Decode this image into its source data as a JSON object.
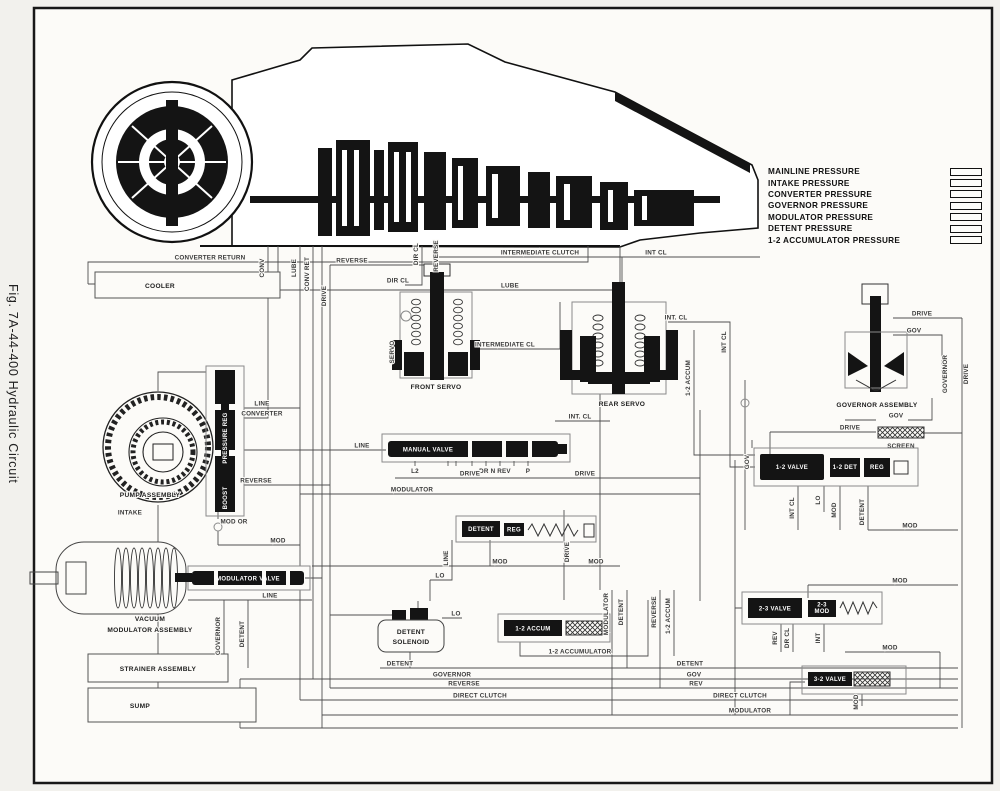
{
  "figure": {
    "caption": "Fig. 7A-44-400 Hydraulic Circuit"
  },
  "legend": {
    "items": [
      {
        "label": "MAINLINE PRESSURE"
      },
      {
        "label": "INTAKE PRESSURE"
      },
      {
        "label": "CONVERTER PRESSURE"
      },
      {
        "label": "GOVERNOR PRESSURE"
      },
      {
        "label": "MODULATOR PRESSURE"
      },
      {
        "label": "DETENT PRESSURE"
      },
      {
        "label": "1-2 ACCUMULATOR PRESSURE"
      }
    ]
  },
  "components": {
    "cooler": "COOLER",
    "pump": "PUMP ASSEMBLY",
    "pressure_reg": "PRESSURE REG",
    "boost": "BOOST",
    "manual_valve": "MANUAL VALVE",
    "front_servo": "FRONT SERVO",
    "rear_servo": "REAR SERVO",
    "governor": "GOVERNOR ASSEMBLY",
    "screen": "SCREEN",
    "modulator_valve": "MODULATOR VALVE",
    "vacuum_modulator_1": "VACUUM",
    "vacuum_modulator_2": "MODULATOR ASSEMBLY",
    "detent_valve": "DETENT",
    "detent_reg": "REG",
    "valve_12": "1-2 VALVE",
    "det_12": "1-2 DET",
    "reg_12": "REG",
    "valve_23": "2-3 VALVE",
    "mod_23_1": "2-3",
    "mod_23_2": "MOD",
    "accum_12": "1-2 ACCUM",
    "valve_32": "3-2 VALVE",
    "detent_solenoid_1": "DETENT",
    "detent_solenoid_2": "SOLENOID",
    "strainer": "STRAINER ASSEMBLY",
    "sump": "SUMP"
  },
  "manual_positions": {
    "l2": "L2",
    "dr_n_rev": "DR N REV",
    "p": "P"
  },
  "line_labels": {
    "converter_return": "CONVERTER RETURN",
    "lube": "LUBE",
    "conv": "CONV",
    "conv_ret": "CONV RET",
    "drive": "DRIVE",
    "reverse": "REVERSE",
    "dir_cl": "DIR CL",
    "intermediate_clutch": "INTERMEDIATE CLUTCH",
    "intermediate_cl": "INTERMEDIATE CL",
    "int_cl": "INT CL",
    "int_cl_dot": "INT. CL",
    "servo": "SERVO",
    "line": "LINE",
    "converter": "CONVERTER",
    "intake": "INTAKE",
    "governor": "GOVERNOR",
    "gov": "GOV",
    "mod": "MOD",
    "mod_or": "MOD OR",
    "modulator": "MODULATOR",
    "detent": "DETENT",
    "lo": "LO",
    "rev": "REV",
    "dr_cl": "DR CL",
    "int": "INT",
    "direct_clutch": "DIRECT CLUTCH",
    "accum_12": "1-2 ACCUM",
    "accumulator_12": "1-2 ACCUMULATOR"
  }
}
